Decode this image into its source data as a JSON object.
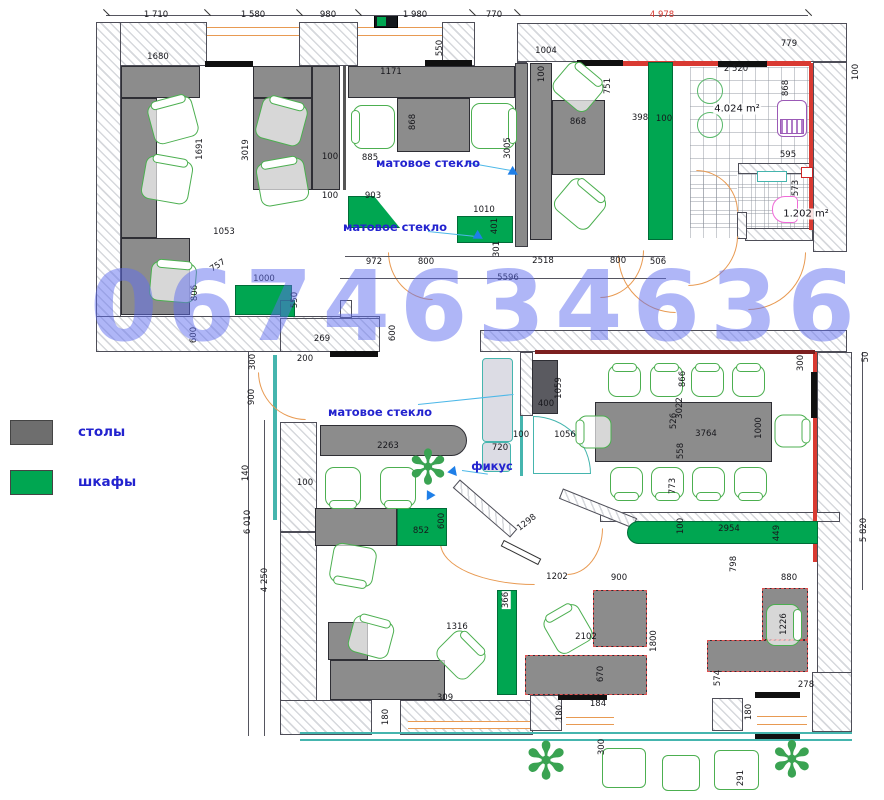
{
  "watermark": "0674634636",
  "legend": {
    "items": [
      {
        "label": "столы",
        "color": "#6e6e6e"
      },
      {
        "label": "шкафы",
        "color": "#00a651"
      }
    ]
  },
  "annotations": [
    {
      "text": "матовое стекло",
      "x": 428,
      "y": 163
    },
    {
      "text": "матовое стекло",
      "x": 395,
      "y": 227
    },
    {
      "text": "матовое стекло",
      "x": 380,
      "y": 412
    },
    {
      "text": "фикус",
      "x": 492,
      "y": 466
    }
  ],
  "area_labels": [
    {
      "text": "4.024 m²",
      "x": 737,
      "y": 109
    },
    {
      "text": "1.202 m²",
      "x": 806,
      "y": 214
    }
  ],
  "colors": {
    "desk_gray": "#8c8c8c",
    "cabinet_green": "#00a651",
    "chair_green": "#4caf50",
    "window_orange": "#e89a52",
    "accent_red": "#d93a32",
    "glass_teal": "#45b5ae",
    "label_blue": "#2323cf",
    "watermark_blue": "#5f6ef0",
    "sink_purple": "#9b59b6",
    "toilet_pink": "#f06ad8"
  },
  "dimensions": [
    {
      "t": "1 710",
      "x": 156,
      "y": 15
    },
    {
      "t": "1 580",
      "x": 253,
      "y": 15
    },
    {
      "t": "980",
      "x": 328,
      "y": 15
    },
    {
      "t": "1 980",
      "x": 415,
      "y": 15
    },
    {
      "t": "770",
      "x": 494,
      "y": 15
    },
    {
      "t": "4 978",
      "x": 662,
      "y": 15,
      "c": 1
    },
    {
      "t": "1680",
      "x": 158,
      "y": 57
    },
    {
      "t": "550",
      "x": 440,
      "y": 48,
      "r": -90
    },
    {
      "t": "1171",
      "x": 391,
      "y": 72
    },
    {
      "t": "1004",
      "x": 546,
      "y": 51
    },
    {
      "t": "100",
      "x": 542,
      "y": 74,
      "r": -90
    },
    {
      "t": "751",
      "x": 608,
      "y": 86,
      "r": -90
    },
    {
      "t": "779",
      "x": 789,
      "y": 44
    },
    {
      "t": "2 520",
      "x": 736,
      "y": 69
    },
    {
      "t": "100",
      "x": 856,
      "y": 72,
      "r": -90
    },
    {
      "t": "868",
      "x": 786,
      "y": 88,
      "r": -90
    },
    {
      "t": "1691",
      "x": 200,
      "y": 149,
      "r": -90
    },
    {
      "t": "3019",
      "x": 246,
      "y": 150,
      "r": -90
    },
    {
      "t": "868",
      "x": 413,
      "y": 122,
      "r": -90
    },
    {
      "t": "868",
      "x": 578,
      "y": 122
    },
    {
      "t": "885",
      "x": 370,
      "y": 158
    },
    {
      "t": "100",
      "x": 330,
      "y": 157
    },
    {
      "t": "100",
      "x": 330,
      "y": 196
    },
    {
      "t": "3005",
      "x": 508,
      "y": 148,
      "r": -90
    },
    {
      "t": "903",
      "x": 373,
      "y": 196
    },
    {
      "t": "1010",
      "x": 484,
      "y": 210
    },
    {
      "t": "401",
      "x": 495,
      "y": 226,
      "r": -90
    },
    {
      "t": "301",
      "x": 497,
      "y": 249,
      "r": -90
    },
    {
      "t": "398",
      "x": 640,
      "y": 118
    },
    {
      "t": "100",
      "x": 664,
      "y": 119
    },
    {
      "t": "972",
      "x": 374,
      "y": 262
    },
    {
      "t": "800",
      "x": 426,
      "y": 262
    },
    {
      "t": "2518",
      "x": 543,
      "y": 261
    },
    {
      "t": "800",
      "x": 618,
      "y": 261
    },
    {
      "t": "506",
      "x": 658,
      "y": 262
    },
    {
      "t": "5596",
      "x": 508,
      "y": 278
    },
    {
      "t": "595",
      "x": 788,
      "y": 155
    },
    {
      "t": "573",
      "x": 796,
      "y": 188,
      "r": -90
    },
    {
      "t": "757",
      "x": 218,
      "y": 266,
      "r": -33
    },
    {
      "t": "1000",
      "x": 264,
      "y": 279
    },
    {
      "t": "806",
      "x": 195,
      "y": 293,
      "r": -90
    },
    {
      "t": "550",
      "x": 295,
      "y": 300,
      "r": -90
    },
    {
      "t": "1053",
      "x": 224,
      "y": 232
    },
    {
      "t": "600",
      "x": 194,
      "y": 335,
      "r": -90
    },
    {
      "t": "269",
      "x": 322,
      "y": 339
    },
    {
      "t": "200",
      "x": 305,
      "y": 359
    },
    {
      "t": "600",
      "x": 393,
      "y": 333,
      "r": -90
    },
    {
      "t": "300",
      "x": 253,
      "y": 362,
      "r": -90
    },
    {
      "t": "900",
      "x": 252,
      "y": 397,
      "r": -90
    },
    {
      "t": "140",
      "x": 246,
      "y": 473,
      "r": -90
    },
    {
      "t": "100",
      "x": 305,
      "y": 483
    },
    {
      "t": "2263",
      "x": 388,
      "y": 446
    },
    {
      "t": "6 010",
      "x": 248,
      "y": 522,
      "r": -90
    },
    {
      "t": "4 250",
      "x": 265,
      "y": 580,
      "r": -90
    },
    {
      "t": "852",
      "x": 421,
      "y": 531
    },
    {
      "t": "600",
      "x": 442,
      "y": 521,
      "r": -90
    },
    {
      "t": "720",
      "x": 500,
      "y": 448
    },
    {
      "t": "100",
      "x": 521,
      "y": 435
    },
    {
      "t": "1056",
      "x": 565,
      "y": 435
    },
    {
      "t": "400",
      "x": 546,
      "y": 404
    },
    {
      "t": "1059",
      "x": 559,
      "y": 388,
      "r": -90
    },
    {
      "t": "1298",
      "x": 527,
      "y": 523,
      "r": -38
    },
    {
      "t": "366",
      "x": 506,
      "y": 600,
      "r": -90,
      "bg": 1
    },
    {
      "t": "1316",
      "x": 457,
      "y": 627
    },
    {
      "t": "309",
      "x": 445,
      "y": 698
    },
    {
      "t": "180",
      "x": 386,
      "y": 717,
      "r": -90
    },
    {
      "t": "184",
      "x": 598,
      "y": 704
    },
    {
      "t": "180",
      "x": 560,
      "y": 713,
      "r": -90
    },
    {
      "t": "2102",
      "x": 586,
      "y": 637
    },
    {
      "t": "1800",
      "x": 654,
      "y": 641,
      "r": -90
    },
    {
      "t": "670",
      "x": 601,
      "y": 674,
      "r": -90
    },
    {
      "t": "1202",
      "x": 557,
      "y": 577
    },
    {
      "t": "900",
      "x": 619,
      "y": 578
    },
    {
      "t": "880",
      "x": 789,
      "y": 578
    },
    {
      "t": "1226",
      "x": 784,
      "y": 624,
      "r": -90
    },
    {
      "t": "574",
      "x": 718,
      "y": 678,
      "r": -90
    },
    {
      "t": "278",
      "x": 806,
      "y": 685
    },
    {
      "t": "180",
      "x": 749,
      "y": 712,
      "r": -90
    },
    {
      "t": "798",
      "x": 734,
      "y": 564,
      "r": -90
    },
    {
      "t": "2954",
      "x": 729,
      "y": 529
    },
    {
      "t": "100",
      "x": 681,
      "y": 526,
      "r": -90
    },
    {
      "t": "449",
      "x": 777,
      "y": 533,
      "r": -90
    },
    {
      "t": "866",
      "x": 683,
      "y": 379,
      "r": -90
    },
    {
      "t": "3022",
      "x": 680,
      "y": 408,
      "r": -90
    },
    {
      "t": "526",
      "x": 674,
      "y": 421,
      "r": -90
    },
    {
      "t": "558",
      "x": 681,
      "y": 451,
      "r": -90
    },
    {
      "t": "773",
      "x": 673,
      "y": 486,
      "r": -90
    },
    {
      "t": "3764",
      "x": 706,
      "y": 434
    },
    {
      "t": "1000",
      "x": 759,
      "y": 428,
      "r": -90
    },
    {
      "t": "300",
      "x": 801,
      "y": 363,
      "r": -90
    },
    {
      "t": "50",
      "x": 866,
      "y": 357,
      "r": -90
    },
    {
      "t": "5 820",
      "x": 864,
      "y": 530,
      "r": -90
    },
    {
      "t": "300",
      "x": 602,
      "y": 747,
      "r": -90
    },
    {
      "t": "291",
      "x": 741,
      "y": 778,
      "r": -90
    }
  ]
}
